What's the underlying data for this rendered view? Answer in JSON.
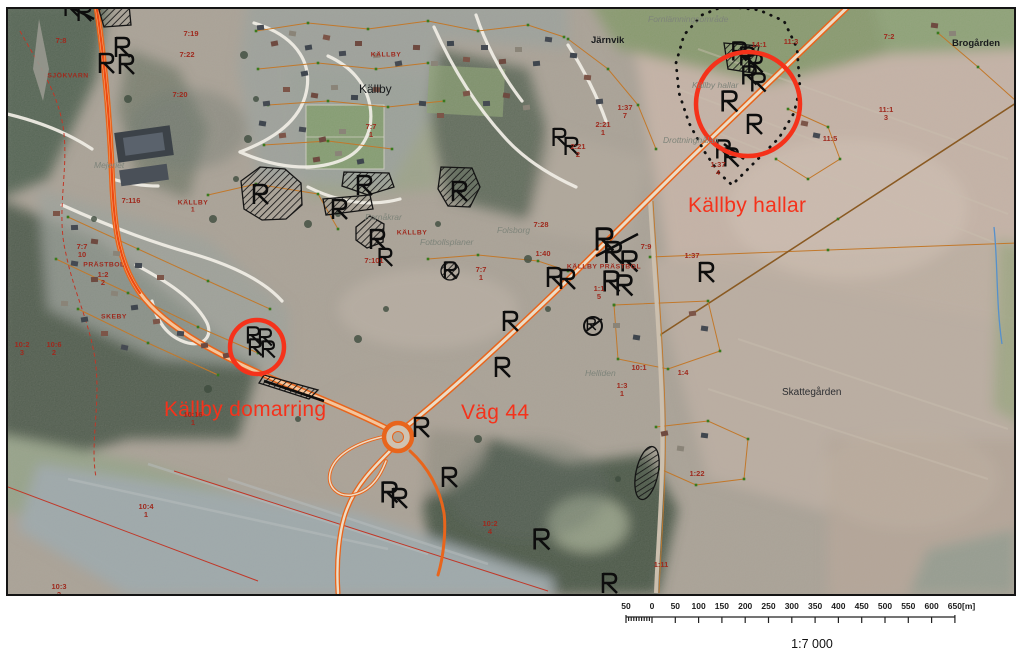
{
  "map": {
    "region": "Källby aerial cadastral map",
    "labels": {
      "major": [
        {
          "text": "Källby hallar",
          "x": 680,
          "y": 186
        },
        {
          "text": "Källby domarring",
          "x": 156,
          "y": 390
        },
        {
          "text": "Väg 44",
          "x": 453,
          "y": 393
        }
      ],
      "places": [
        {
          "text": "Källby",
          "x": 351,
          "y": 74,
          "cls": "lg"
        },
        {
          "text": "Järnvik",
          "x": 583,
          "y": 27,
          "cls": ""
        },
        {
          "text": "Brogården",
          "x": 944,
          "y": 30,
          "cls": ""
        },
        {
          "text": "Skattegården",
          "x": 774,
          "y": 379,
          "cls": "dk"
        }
      ],
      "areas": [
        {
          "text": "Fornlämningsområde",
          "x": 640,
          "y": 6
        },
        {
          "text": "Källby hallar",
          "x": 684,
          "y": 72
        },
        {
          "text": "Drottninghålan",
          "x": 655,
          "y": 127
        },
        {
          "text": "Fornåkrar",
          "x": 357,
          "y": 204
        },
        {
          "text": "Fotbollsplaner",
          "x": 412,
          "y": 229
        },
        {
          "text": "Folsborg",
          "x": 489,
          "y": 217
        },
        {
          "text": "Helliden",
          "x": 577,
          "y": 360
        },
        {
          "text": "Mejeriet",
          "x": 86,
          "y": 152
        }
      ],
      "parcels": [
        {
          "text": "7:8",
          "x": 53,
          "y": 32
        },
        {
          "text": "SJÖKVARN",
          "x": 60,
          "y": 67,
          "caps": true
        },
        {
          "text": "7:19",
          "x": 183,
          "y": 25
        },
        {
          "text": "7:22",
          "x": 179,
          "y": 46
        },
        {
          "text": "7:20",
          "x": 172,
          "y": 86
        },
        {
          "text": "7:116",
          "x": 123,
          "y": 192
        },
        {
          "text": "KÄLLBY\n1",
          "x": 185,
          "y": 198,
          "caps": true
        },
        {
          "text": "7:7\n10",
          "x": 74,
          "y": 242
        },
        {
          "text": "PRÄSTBOL",
          "x": 96,
          "y": 256,
          "caps": true
        },
        {
          "text": "1:2\n2",
          "x": 95,
          "y": 270
        },
        {
          "text": "SKEBY",
          "x": 106,
          "y": 308,
          "caps": true
        },
        {
          "text": "10:2\n3",
          "x": 14,
          "y": 340
        },
        {
          "text": "10:6\n2",
          "x": 46,
          "y": 340
        },
        {
          "text": "10:16\n1",
          "x": 185,
          "y": 410
        },
        {
          "text": "10:4\n1",
          "x": 138,
          "y": 502
        },
        {
          "text": "10:3\n2",
          "x": 51,
          "y": 582
        },
        {
          "text": "10:2\n4",
          "x": 482,
          "y": 519
        },
        {
          "text": "7:7\n1",
          "x": 363,
          "y": 122
        },
        {
          "text": "KÄLLBY",
          "x": 378,
          "y": 46,
          "caps": true
        },
        {
          "text": "7:7\n1",
          "x": 473,
          "y": 265
        },
        {
          "text": "7:28",
          "x": 533,
          "y": 216
        },
        {
          "text": "1:40",
          "x": 535,
          "y": 245
        },
        {
          "text": "KÄLLBY",
          "x": 404,
          "y": 224,
          "caps": true
        },
        {
          "text": "7:101",
          "x": 366,
          "y": 252
        },
        {
          "text": "KÄLLBY PRÄSTBOL",
          "x": 596,
          "y": 258,
          "caps": true
        },
        {
          "text": "1:1\n5",
          "x": 591,
          "y": 284
        },
        {
          "text": "7:9",
          "x": 638,
          "y": 238
        },
        {
          "text": "1:37",
          "x": 684,
          "y": 247
        },
        {
          "text": "1:37\n7",
          "x": 617,
          "y": 103
        },
        {
          "text": "2:21\n1",
          "x": 595,
          "y": 120
        },
        {
          "text": "2:21\n2",
          "x": 570,
          "y": 142
        },
        {
          "text": "14:1",
          "x": 751,
          "y": 36
        },
        {
          "text": "11:3",
          "x": 783,
          "y": 33
        },
        {
          "text": "1:37\n4",
          "x": 710,
          "y": 160
        },
        {
          "text": "11:5",
          "x": 822,
          "y": 130
        },
        {
          "text": "11:1\n3",
          "x": 878,
          "y": 105
        },
        {
          "text": "7:2",
          "x": 881,
          "y": 28
        },
        {
          "text": "10:1",
          "x": 631,
          "y": 359
        },
        {
          "text": "1:4",
          "x": 675,
          "y": 364
        },
        {
          "text": "1:3\n1",
          "x": 614,
          "y": 381
        },
        {
          "text": "1:22",
          "x": 689,
          "y": 465
        },
        {
          "text": "1:11",
          "x": 653,
          "y": 556
        }
      ]
    },
    "features": {
      "runestones": [
        [
          63,
          -2,
          0.9
        ],
        [
          76,
          3,
          0.9
        ],
        [
          114,
          38,
          1
        ],
        [
          98,
          54,
          1
        ],
        [
          118,
          55,
          1
        ],
        [
          252,
          185,
          1
        ],
        [
          356,
          176,
          1
        ],
        [
          331,
          200,
          1
        ],
        [
          451,
          182,
          1
        ],
        [
          369,
          230,
          1
        ],
        [
          377,
          248,
          0.9
        ],
        [
          442,
          261,
          0.85
        ],
        [
          245,
          326,
          0.85
        ],
        [
          257,
          328,
          0.85
        ],
        [
          247,
          338,
          0.85
        ],
        [
          260,
          340,
          0.85
        ],
        [
          551,
          128,
          0.9
        ],
        [
          563,
          137,
          0.9
        ],
        [
          502,
          312,
          1
        ],
        [
          494,
          358,
          1
        ],
        [
          546,
          268,
          1
        ],
        [
          559,
          270,
          1
        ],
        [
          596,
          230,
          1.15
        ],
        [
          605,
          243,
          1.1
        ],
        [
          621,
          252,
          1.05
        ],
        [
          603,
          272,
          1.05
        ],
        [
          616,
          276,
          1.05
        ],
        [
          698,
          263,
          1
        ],
        [
          731,
          42,
          0.95
        ],
        [
          739,
          47,
          0.95
        ],
        [
          747,
          54,
          0.95
        ],
        [
          741,
          66,
          0.95
        ],
        [
          750,
          73,
          0.95
        ],
        [
          721,
          92,
          1.05
        ],
        [
          746,
          115,
          1
        ],
        [
          715,
          140,
          0.95
        ],
        [
          723,
          148,
          0.95
        ],
        [
          413,
          418,
          1
        ],
        [
          441,
          468,
          1
        ],
        [
          381,
          483,
          1.05
        ],
        [
          391,
          489,
          1
        ],
        [
          533,
          530,
          1.05
        ],
        [
          601,
          574,
          1
        ],
        [
          583,
          315,
          0.6
        ]
      ],
      "highlight_circles": [
        {
          "cx": 740,
          "cy": 95,
          "r": 52
        },
        {
          "cx": 249,
          "cy": 338,
          "r": 27
        }
      ],
      "symbols": {
        "runestone_icon": "runic-R ancient monument marker",
        "monument_circle_icon": "circled ancient monument marker",
        "hatched_area": "black diagonal hatched monument area",
        "dotted_boundary": "dotted monument area boundary",
        "highlight_circle": "red highlight circle"
      }
    }
  },
  "scalebar": {
    "numbers": [
      "50",
      "0",
      "50",
      "100",
      "150",
      "200",
      "250",
      "300",
      "350",
      "400",
      "450",
      "500",
      "550",
      "600",
      "650"
    ],
    "unit": "[m]",
    "ratio": "1:7 000"
  },
  "colors": {
    "highlight_red": "#f5321b",
    "parcel_red": "#9e2a1e",
    "area_gray": "#7e847a",
    "road_orange": "#e8651c",
    "boundary_orange": "#c2782a",
    "vertex_green": "#3a7a1e"
  }
}
